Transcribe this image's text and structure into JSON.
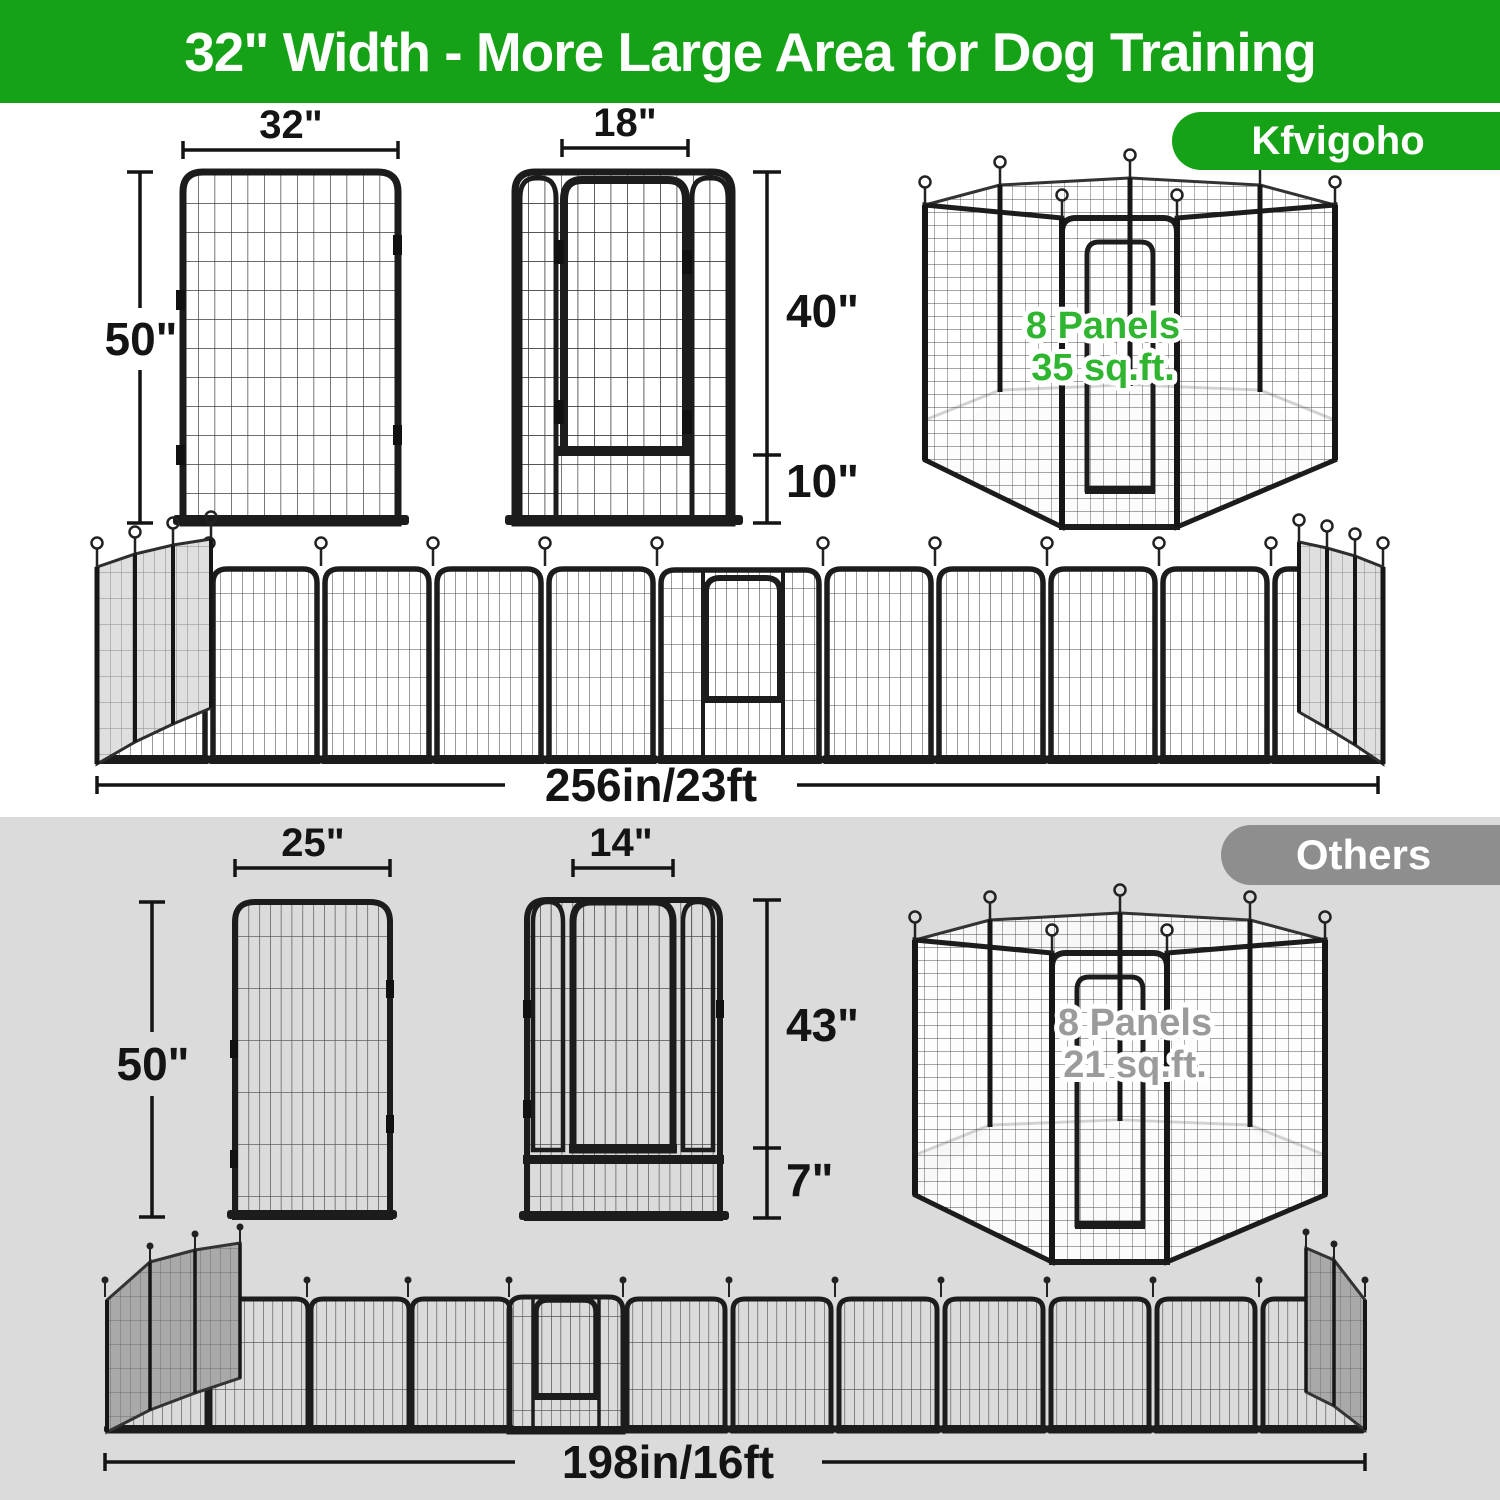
{
  "header": {
    "title": "32\" Width - More Large Area for Dog Training"
  },
  "brand_badge": {
    "label": "Kfvigoho"
  },
  "others_badge": {
    "label": "Others"
  },
  "kfvigoho": {
    "panel": {
      "width_label": "32\"",
      "height_label": "50\""
    },
    "door_panel": {
      "door_width_label": "18\"",
      "door_height_label": "40\"",
      "bottom_height_label": "10\""
    },
    "pen": {
      "line1": "8 Panels",
      "line2": "35 sq.ft."
    },
    "row": {
      "total_length_label": "256in/23ft"
    }
  },
  "others": {
    "panel": {
      "width_label": "25\"",
      "height_label": "50\""
    },
    "door_panel": {
      "door_width_label": "14\"",
      "door_height_label": "43\"",
      "bottom_height_label": "7\""
    },
    "pen": {
      "line1": "8 Panels",
      "line2": "21 sq.ft."
    },
    "row": {
      "total_length_label": "198in/16ft"
    }
  },
  "colors": {
    "header_green": "#16A216",
    "highlight_green": "#2FB52F",
    "others_badge_gray": "#8E8E8E",
    "others_text_gray": "#9B9B9B",
    "bottom_section_bg": "#DBDBDB",
    "fence_black": "#1C1C1C"
  }
}
